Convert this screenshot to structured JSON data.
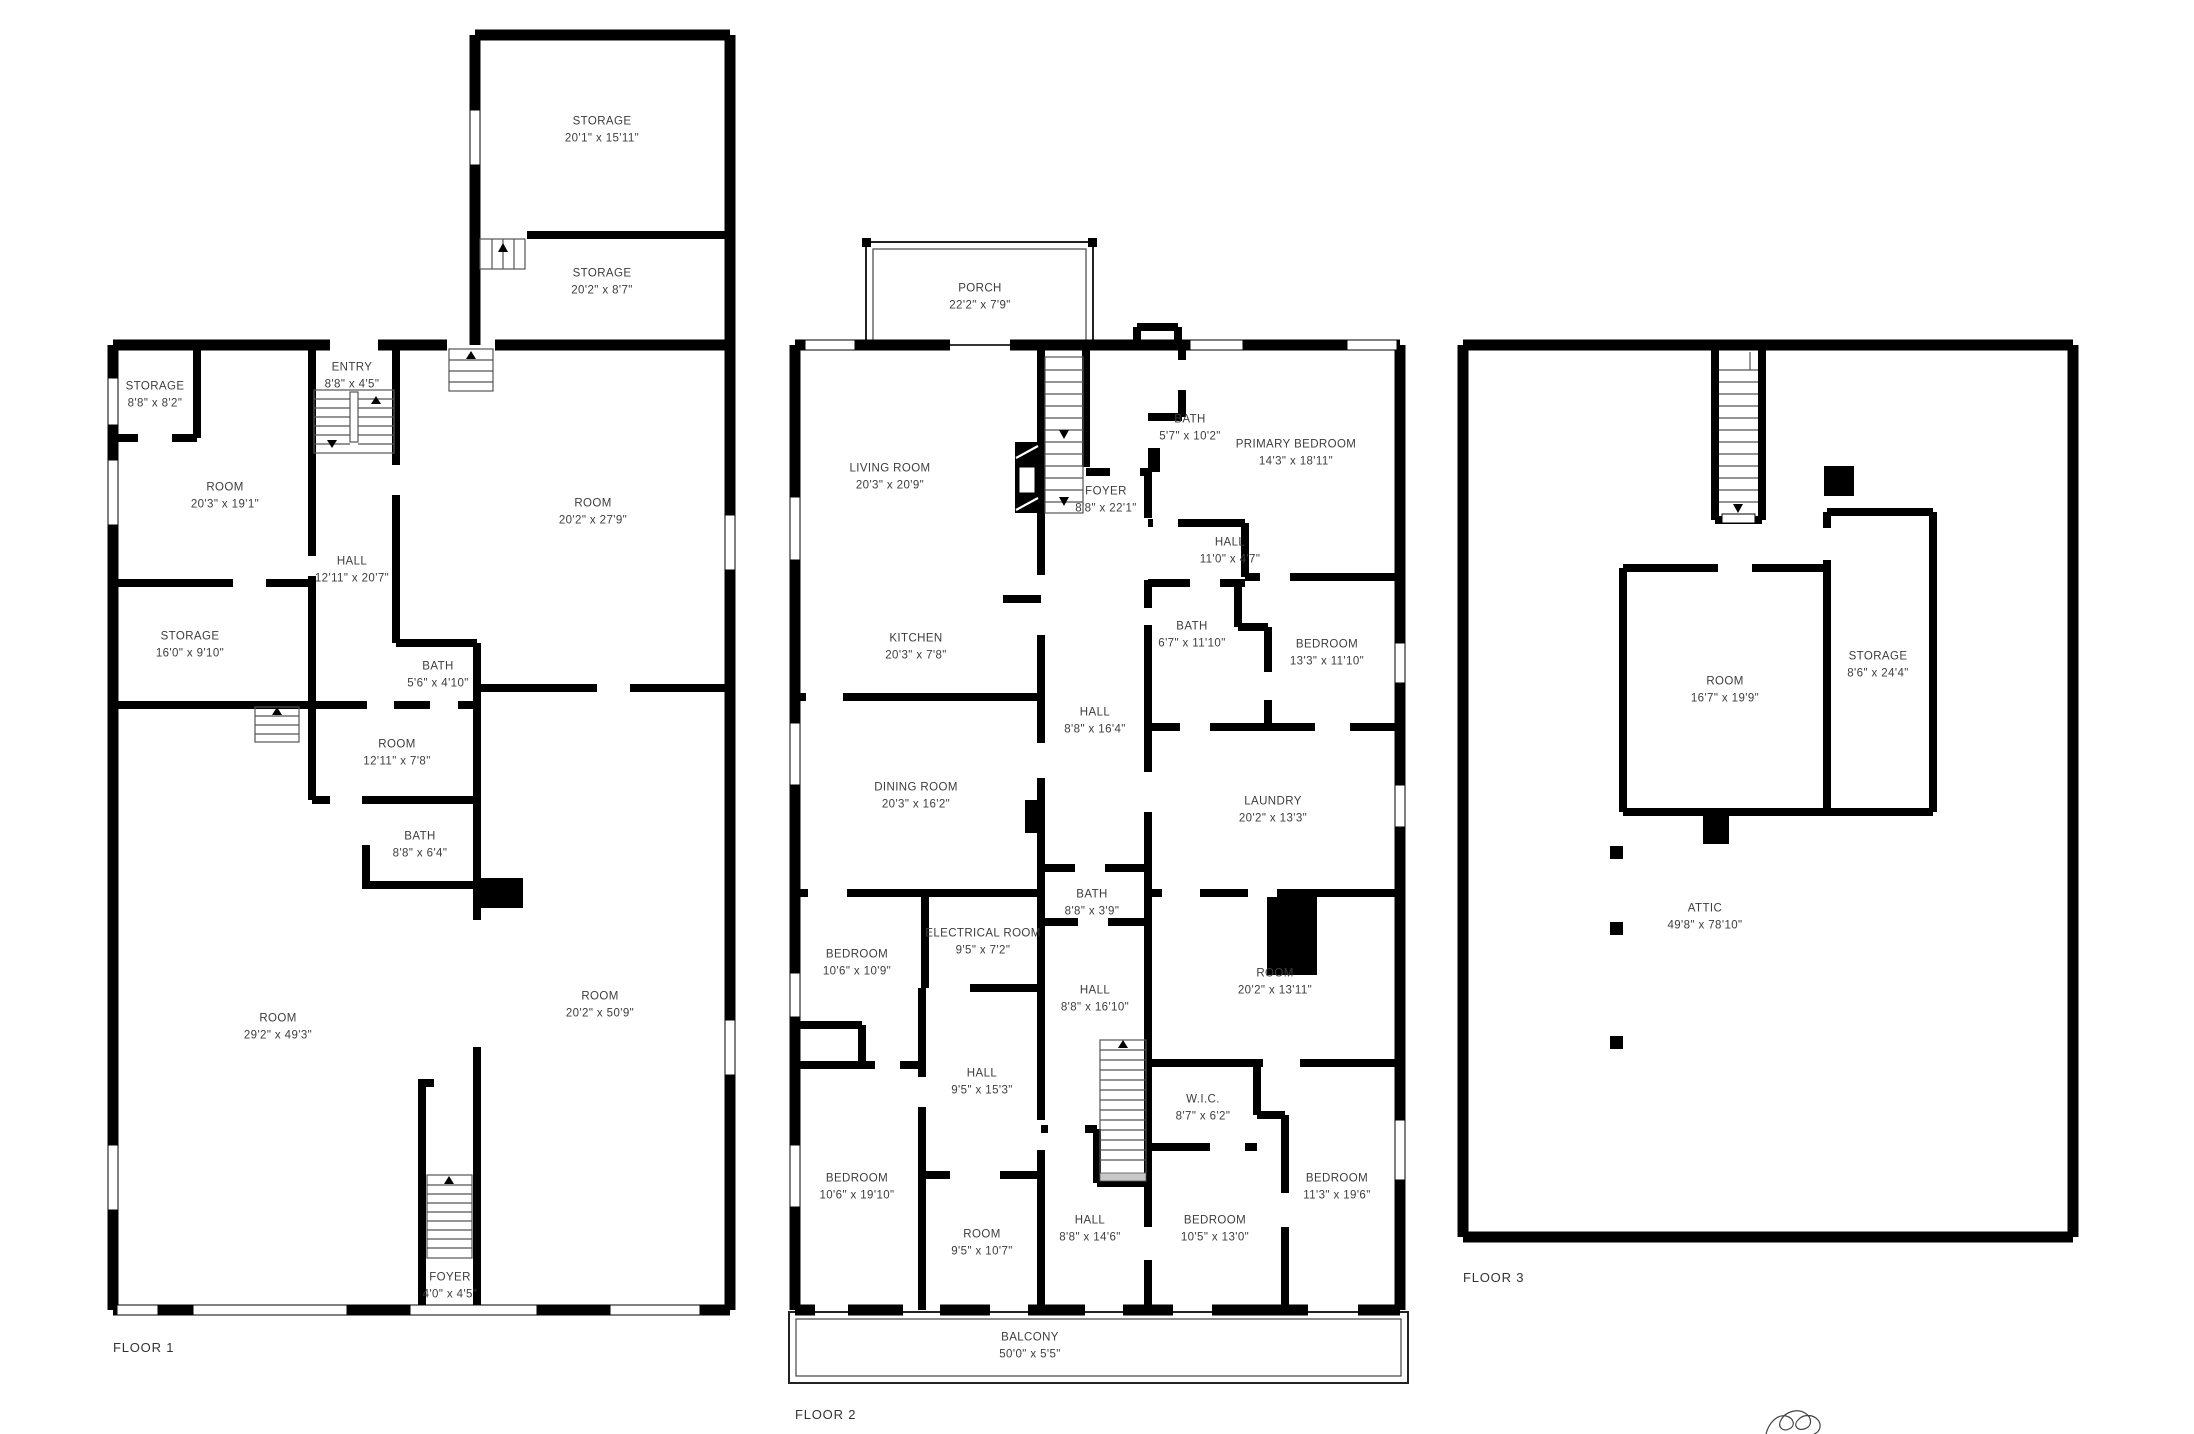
{
  "colors": {
    "wall": "#000000",
    "label_text": "#3d3d3d",
    "background": "#ffffff"
  },
  "floors": [
    {
      "label": "FLOOR 1",
      "rooms": [
        {
          "name": "STORAGE",
          "dims": "20'1\" x 15'11\""
        },
        {
          "name": "STORAGE",
          "dims": "20'2\" x 8'7\""
        },
        {
          "name": "ENTRY",
          "dims": "8'8\" x 4'5\""
        },
        {
          "name": "STORAGE",
          "dims": "8'8\" x 8'2\""
        },
        {
          "name": "ROOM",
          "dims": "20'3\" x 19'1\""
        },
        {
          "name": "ROOM",
          "dims": "20'2\" x 27'9\""
        },
        {
          "name": "HALL",
          "dims": "12'11\" x 20'7\""
        },
        {
          "name": "STORAGE",
          "dims": "16'0\" x 9'10\""
        },
        {
          "name": "BATH",
          "dims": "5'6\" x 4'10\""
        },
        {
          "name": "ROOM",
          "dims": "12'11\" x 7'8\""
        },
        {
          "name": "BATH",
          "dims": "8'8\" x 6'4\""
        },
        {
          "name": "ROOM",
          "dims": "29'2\" x 49'3\""
        },
        {
          "name": "ROOM",
          "dims": "20'2\" x 50'9\""
        },
        {
          "name": "FOYER",
          "dims": "4'0\" x 4'5\""
        }
      ]
    },
    {
      "label": "FLOOR 2",
      "rooms": [
        {
          "name": "PORCH",
          "dims": "22'2\" x 7'9\""
        },
        {
          "name": "LIVING ROOM",
          "dims": "20'3\" x 20'9\""
        },
        {
          "name": "FOYER",
          "dims": "8'8\" x 22'1\""
        },
        {
          "name": "BATH",
          "dims": "5'7\" x 10'2\""
        },
        {
          "name": "PRIMARY BEDROOM",
          "dims": "14'3\" x 18'11\""
        },
        {
          "name": "HALL",
          "dims": "11'0\" x 4'7\""
        },
        {
          "name": "BATH",
          "dims": "6'7\" x 11'10\""
        },
        {
          "name": "BEDROOM",
          "dims": "13'3\" x 11'10\""
        },
        {
          "name": "KITCHEN",
          "dims": "20'3\" x 7'8\""
        },
        {
          "name": "HALL",
          "dims": "8'8\" x 16'4\""
        },
        {
          "name": "DINING ROOM",
          "dims": "20'3\" x 16'2\""
        },
        {
          "name": "LAUNDRY",
          "dims": "20'2\" x 13'3\""
        },
        {
          "name": "BATH",
          "dims": "8'8\" x 3'9\""
        },
        {
          "name": "ELECTRICAL ROOM",
          "dims": "9'5\" x 7'2\""
        },
        {
          "name": "BEDROOM",
          "dims": "10'6\" x 10'9\""
        },
        {
          "name": "HALL",
          "dims": "8'8\" x 16'10\""
        },
        {
          "name": "ROOM",
          "dims": "20'2\" x 13'11\""
        },
        {
          "name": "HALL",
          "dims": "9'5\" x 15'3\""
        },
        {
          "name": "W.I.C.",
          "dims": "8'7\" x 6'2\""
        },
        {
          "name": "BEDROOM",
          "dims": "10'6\" x 19'10\""
        },
        {
          "name": "ROOM",
          "dims": "9'5\" x 10'7\""
        },
        {
          "name": "HALL",
          "dims": "8'8\" x 14'6\""
        },
        {
          "name": "BEDROOM",
          "dims": "10'5\" x 13'0\""
        },
        {
          "name": "BEDROOM",
          "dims": "11'3\" x 19'6\""
        },
        {
          "name": "BALCONY",
          "dims": "50'0\" x 5'5\""
        }
      ]
    },
    {
      "label": "FLOOR 3",
      "rooms": [
        {
          "name": "ROOM",
          "dims": "16'7\" x 19'9\""
        },
        {
          "name": "STORAGE",
          "dims": "8'6\" x 24'4\""
        },
        {
          "name": "ATTIC",
          "dims": "49'8\" x 78'10\""
        }
      ]
    }
  ]
}
